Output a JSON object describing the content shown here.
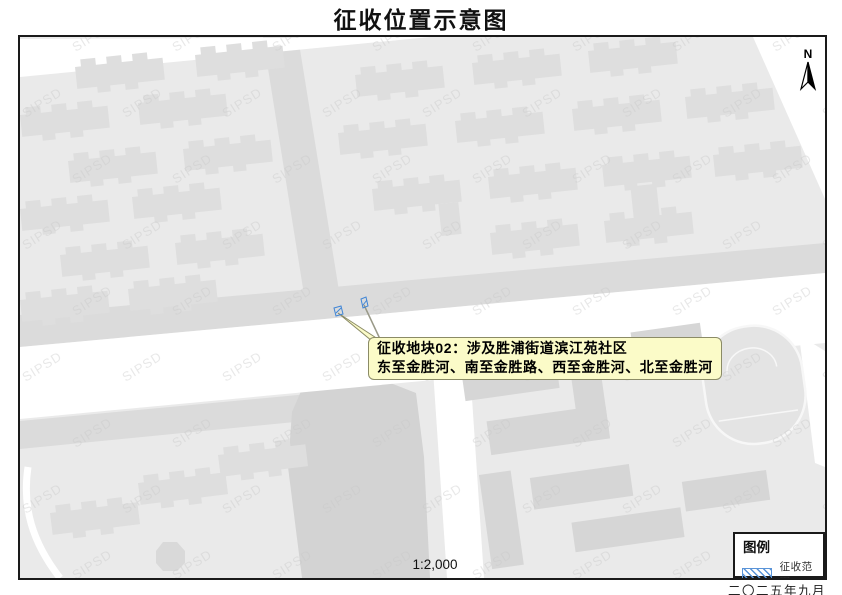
{
  "title": "征收位置示意图",
  "map": {
    "callout": {
      "line1": "征收地块02：涉及胜浦街道滨江苑社区",
      "line2": "东至金胜河、南至金胜路、西至金胜河、北至金胜河"
    },
    "scale_text": "1:2,000",
    "north_label": "N",
    "watermark_text": "SIPSD"
  },
  "legend": {
    "title": "图例",
    "items": [
      {
        "label": "征收范围",
        "swatch": "blue-diagonal-hatch"
      }
    ]
  },
  "footer": {
    "date": "二〇二五年九月"
  },
  "colors": {
    "map-bg": "#EAEAEA",
    "road": "#FFFFFF",
    "river": "#DBDBDB",
    "water": "#D3D3D3",
    "building": "#DEDEDE",
    "building-dark": "#D6D6D6",
    "field": "#E4E4E4",
    "callout-bg": "#FBFBC8",
    "callout-border": "#8B8B66",
    "parcel-blue": "#3F85D6",
    "legend-hatch": "#5A94D8",
    "frame": "#1A1A1A",
    "watermark": "#C9C9C9"
  }
}
